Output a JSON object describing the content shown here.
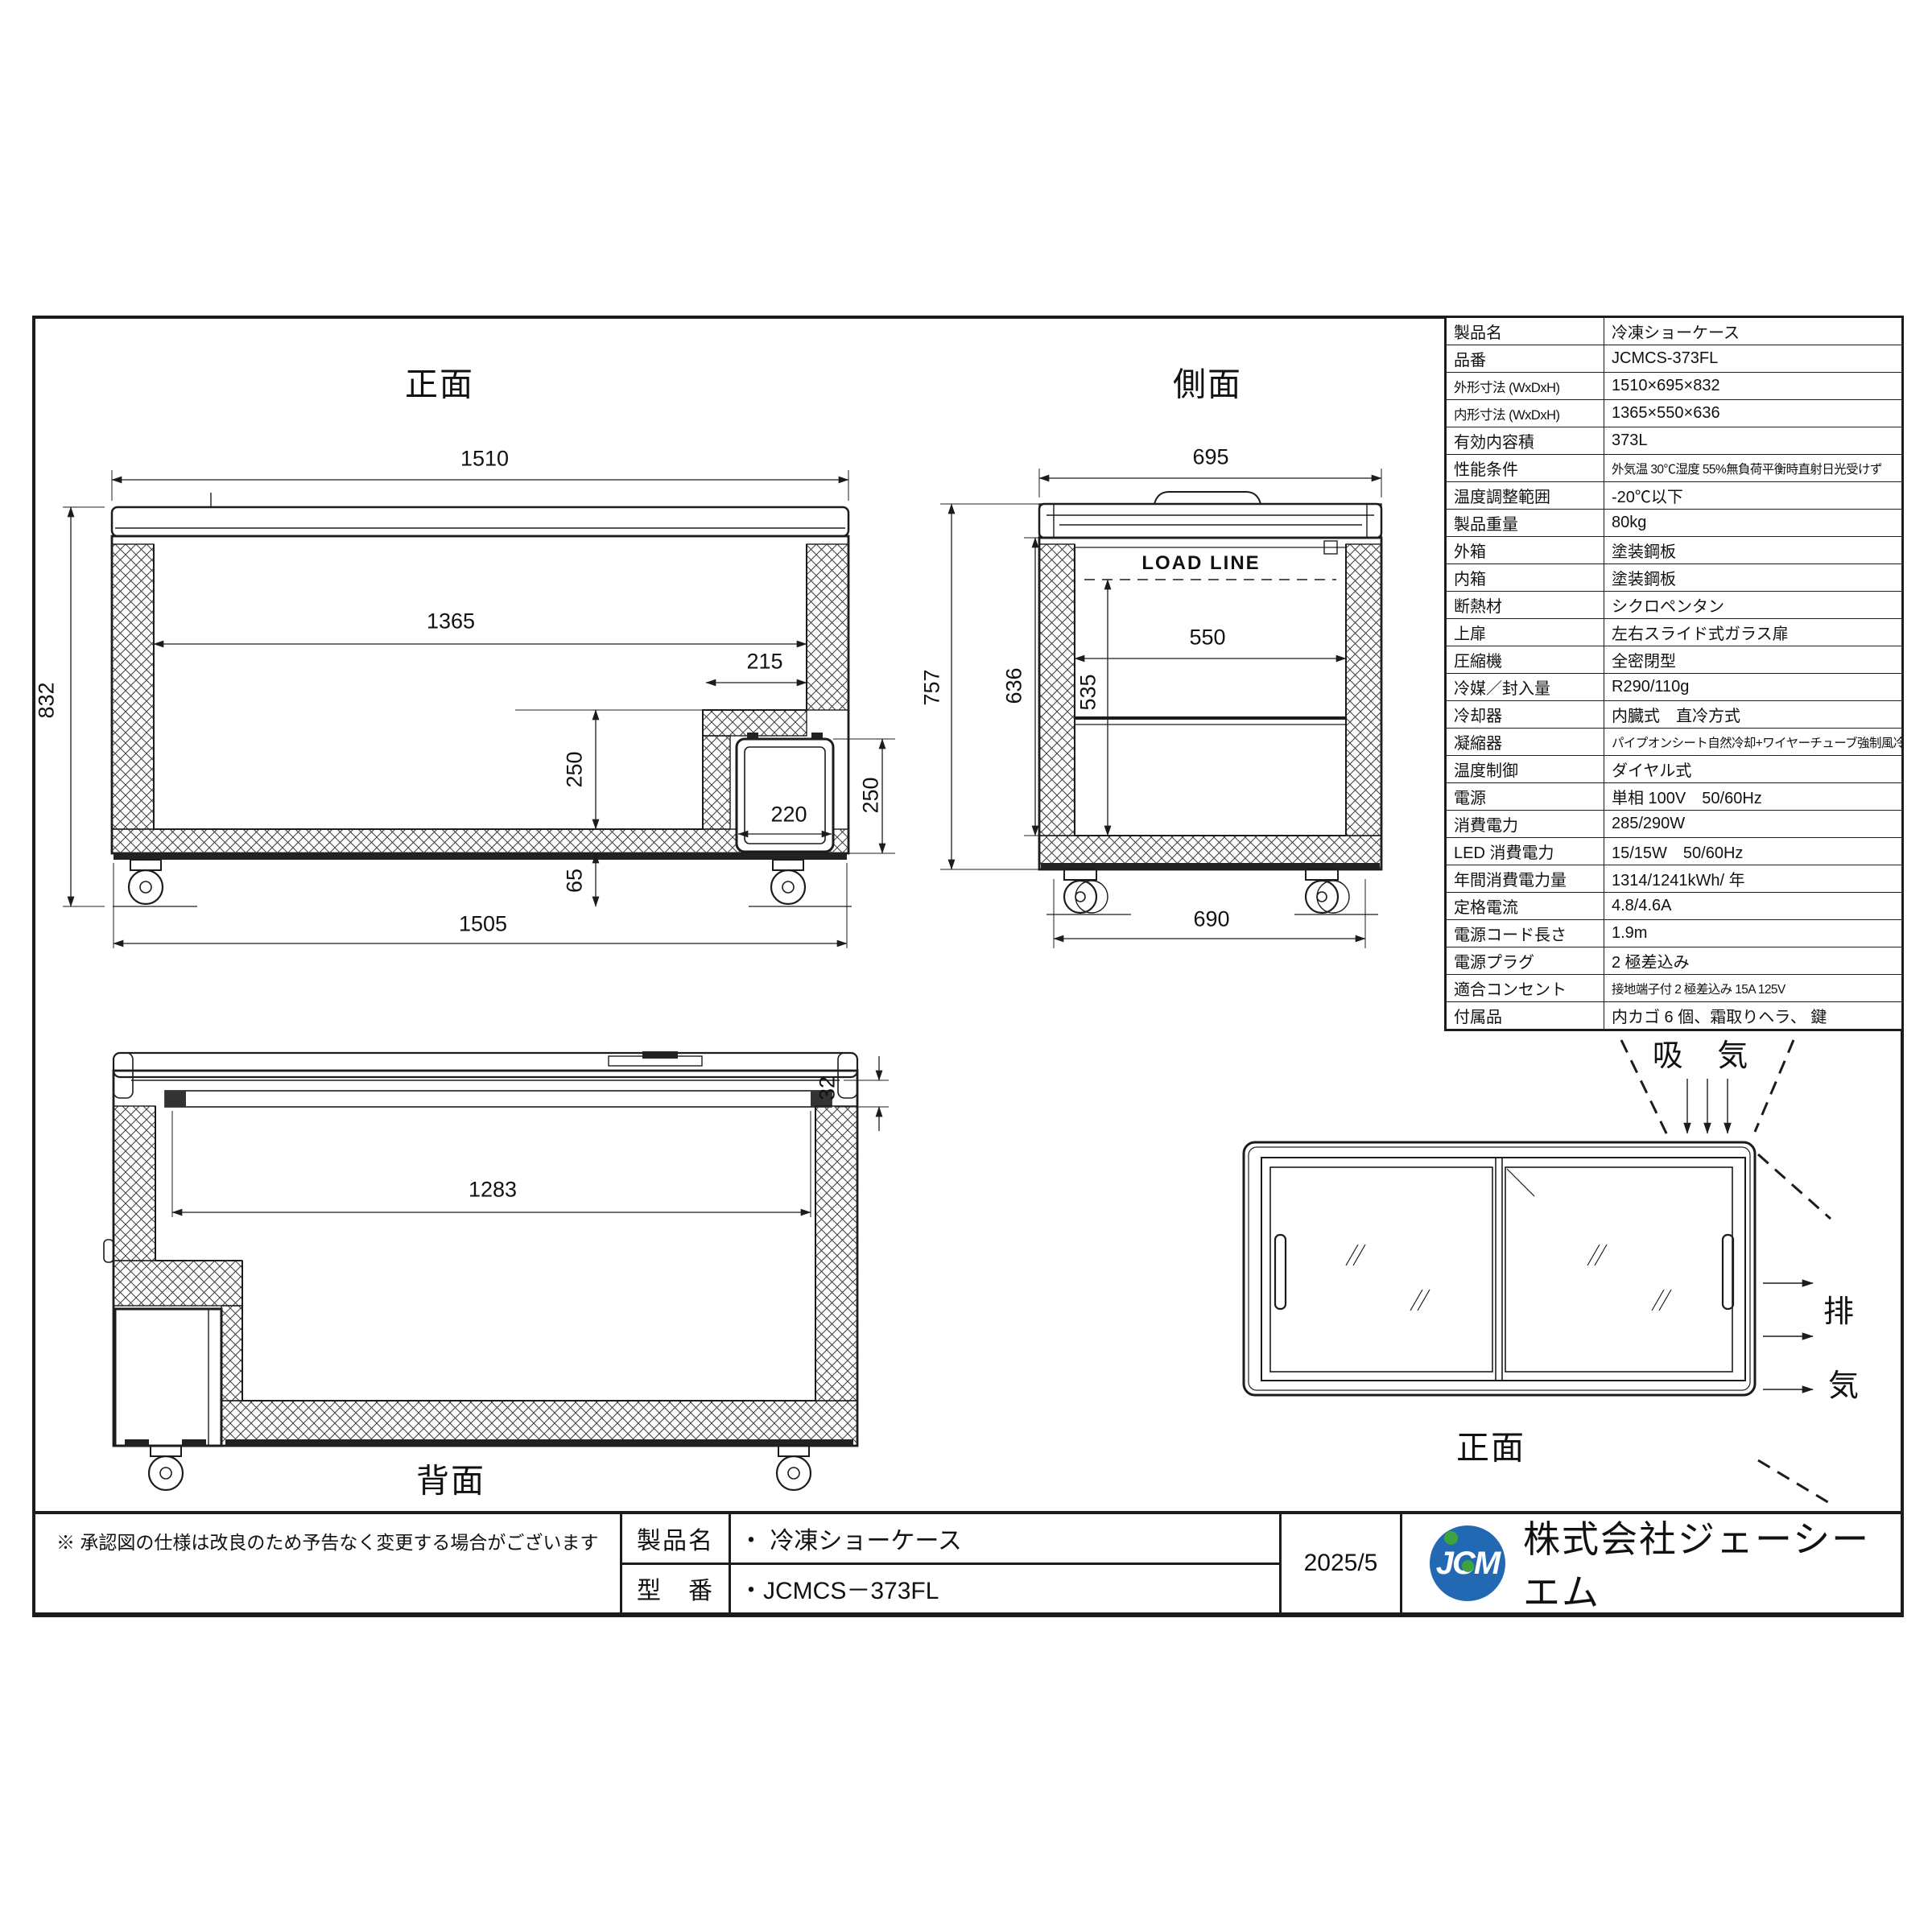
{
  "colors": {
    "line": "#1c1c1c",
    "logo_blue": "#2268b2",
    "logo_green": "#3fa33d"
  },
  "views": {
    "front": {
      "title": "正面"
    },
    "side": {
      "title": "側面",
      "load_line": "LOAD LINE"
    },
    "rear": {
      "title": "背面"
    },
    "top": {
      "title": "正面",
      "intake_label": "吸 気",
      "exhaust_char_1": "排",
      "exhaust_char_2": "気"
    }
  },
  "dims": {
    "front": {
      "overall_width": "1510",
      "overall_height": "832",
      "inner_width": "1365",
      "step_width": "215",
      "step_height": "250",
      "unit_door_width": "220",
      "unit_door_height": "250",
      "base_clearance": "65",
      "base_width": "1505"
    },
    "side": {
      "overall_depth": "695",
      "body_height": "757",
      "inner_height": "636",
      "load_depth_height": "535",
      "inner_depth": "550",
      "base_depth": "690"
    },
    "rear": {
      "opening_width": "1283",
      "frame_thickness": "32"
    }
  },
  "spec_table": {
    "rows": [
      {
        "label": "製品名",
        "value": "冷凍ショーケース"
      },
      {
        "label": "品番",
        "value": "JCMCS-373FL"
      },
      {
        "label": "外形寸法 (WxDxH)",
        "value": "1510×695×832"
      },
      {
        "label": "内形寸法 (WxDxH)",
        "value": "1365×550×636"
      },
      {
        "label": "有効内容積",
        "value": "373L"
      },
      {
        "label": "性能条件",
        "value": "外気温 30℃湿度 55%無負荷平衡時直射日光受けず"
      },
      {
        "label": "温度調整範囲",
        "value": "-20℃以下"
      },
      {
        "label": "製品重量",
        "value": "80kg"
      },
      {
        "label": "外箱",
        "value": "塗装鋼板"
      },
      {
        "label": "内箱",
        "value": "塗装鋼板"
      },
      {
        "label": "断熱材",
        "value": "シクロペンタン"
      },
      {
        "label": "上扉",
        "value": "左右スライド式ガラス扉"
      },
      {
        "label": "圧縮機",
        "value": "全密閉型"
      },
      {
        "label": "冷媒／封入量",
        "value": "R290/110g"
      },
      {
        "label": "冷却器",
        "value": "内臓式　直冷方式"
      },
      {
        "label": "凝縮器",
        "value": "パイプオンシート自然冷却+ワイヤーチューブ強制風冷方式"
      },
      {
        "label": "温度制御",
        "value": "ダイヤル式"
      },
      {
        "label": "電源",
        "value": "単相 100V　50/60Hz"
      },
      {
        "label": "消費電力",
        "value": "285/290W"
      },
      {
        "label": "LED 消費電力",
        "value": "15/15W　50/60Hz"
      },
      {
        "label": "年間消費電力量",
        "value": "1314/1241kWh/ 年"
      },
      {
        "label": "定格電流",
        "value": "4.8/4.6A"
      },
      {
        "label": "電源コード長さ",
        "value": "1.9m"
      },
      {
        "label": "電源プラグ",
        "value": "2 極差込み"
      },
      {
        "label": "適合コンセント",
        "value": "接地端子付 2 極差込み  15A   125V"
      },
      {
        "label": "付属品",
        "value": "内カゴ 6 個、霜取りヘラ、 鍵"
      }
    ]
  },
  "title_block": {
    "disclaimer": "※ 承認図の仕様は改良のため予告なく変更する場合がございます",
    "product_label": "製品名",
    "product_value": "・ 冷凍ショーケース",
    "model_label": "型　番",
    "model_value": "・JCMCS－373FL",
    "date": "2025/5",
    "logo_text": "JCM",
    "company": "株式会社ジェーシーエム"
  }
}
